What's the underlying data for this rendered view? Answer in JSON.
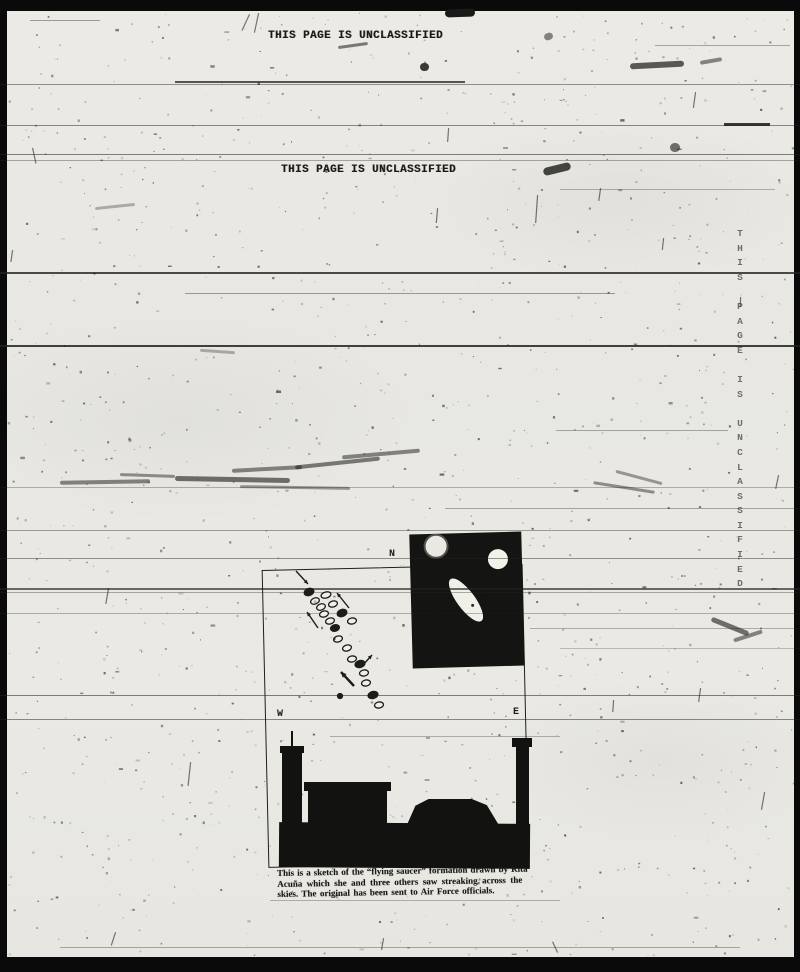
{
  "page": {
    "classification_header": "THIS PAGE IS UNCLASSIFIED",
    "classification_header_2": "THIS PAGE IS UNCLASSIFIED",
    "classification_vertical": "THIS PAGE IS UNCLASSIFIED"
  },
  "colors": {
    "paper": "#e9e8e2",
    "ink": "#191917",
    "border": "#0a0a0a",
    "faint_stamp": "#6e6d68"
  },
  "sketch": {
    "compass_n": "N",
    "compass_w": "W",
    "compass_e": "E",
    "caption_line1": "This is a sketch of the “flying saucer” formation drawn by Rita",
    "caption_line2": "Acuña which she and three others saw streaking across the",
    "caption_line3": "skies. The original has been sent to Air Force officials.",
    "saucers": [
      {
        "cx": 309,
        "cy": 592,
        "rx": 5,
        "ry": 3.5,
        "rot": -20,
        "filled": true
      },
      {
        "cx": 326,
        "cy": 595,
        "rx": 5,
        "ry": 3,
        "rot": -15,
        "filled": false
      },
      {
        "cx": 315,
        "cy": 601,
        "rx": 4.5,
        "ry": 3,
        "rot": -20,
        "filled": false
      },
      {
        "cx": 333,
        "cy": 604,
        "rx": 4.5,
        "ry": 3,
        "rot": -15,
        "filled": false
      },
      {
        "cx": 321,
        "cy": 607,
        "rx": 4.5,
        "ry": 3,
        "rot": -20,
        "filled": false
      },
      {
        "cx": 324,
        "cy": 614,
        "rx": 4.5,
        "ry": 3,
        "rot": -15,
        "filled": false
      },
      {
        "cx": 342,
        "cy": 613,
        "rx": 5,
        "ry": 3.5,
        "rot": -20,
        "filled": true
      },
      {
        "cx": 330,
        "cy": 621,
        "rx": 4.5,
        "ry": 3,
        "rot": -15,
        "filled": false
      },
      {
        "cx": 352,
        "cy": 621,
        "rx": 4.5,
        "ry": 3,
        "rot": -10,
        "filled": false
      },
      {
        "cx": 335,
        "cy": 628,
        "rx": 4.5,
        "ry": 3.2,
        "rot": -15,
        "filled": true
      },
      {
        "cx": 338,
        "cy": 639,
        "rx": 4.5,
        "ry": 3,
        "rot": -15,
        "filled": false
      },
      {
        "cx": 347,
        "cy": 648,
        "rx": 4.5,
        "ry": 3,
        "rot": -15,
        "filled": false
      },
      {
        "cx": 352,
        "cy": 659,
        "rx": 4.5,
        "ry": 3,
        "rot": -10,
        "filled": false
      },
      {
        "cx": 360,
        "cy": 664,
        "rx": 5,
        "ry": 3.5,
        "rot": -15,
        "filled": true
      },
      {
        "cx": 364,
        "cy": 673,
        "rx": 4.5,
        "ry": 3,
        "rot": -10,
        "filled": false
      },
      {
        "cx": 366,
        "cy": 683,
        "rx": 4.5,
        "ry": 3,
        "rot": -10,
        "filled": false
      },
      {
        "cx": 373,
        "cy": 695,
        "rx": 5,
        "ry": 3.5,
        "rot": -15,
        "filled": true
      },
      {
        "cx": 379,
        "cy": 705,
        "rx": 4.5,
        "ry": 3,
        "rot": -10,
        "filled": false
      },
      {
        "cx": 340,
        "cy": 696,
        "rx": 2.5,
        "ry": 2.5,
        "rot": 0,
        "filled": true
      }
    ],
    "arrows": [
      {
        "x1": 296,
        "y1": 571,
        "x2": 308,
        "y2": 584,
        "thick": false
      },
      {
        "x1": 349,
        "y1": 608,
        "x2": 337,
        "y2": 593,
        "thick": false
      },
      {
        "x1": 318,
        "y1": 628,
        "x2": 307,
        "y2": 612,
        "thick": false
      },
      {
        "x1": 362,
        "y1": 666,
        "x2": 372,
        "y2": 655,
        "thick": false
      },
      {
        "x1": 354,
        "y1": 686,
        "x2": 341,
        "y2": 672,
        "thick": true
      }
    ]
  },
  "artifacts": {
    "scan_lines": [
      {
        "y": 20,
        "x1": 30,
        "x2": 100,
        "o": 0.4,
        "h": 1
      },
      {
        "y": 45,
        "x1": 655,
        "x2": 790,
        "o": 0.35,
        "h": 1
      },
      {
        "y": 81,
        "x1": 175,
        "x2": 465,
        "o": 0.75,
        "h": 2
      },
      {
        "y": 84,
        "x1": 0,
        "x2": 800,
        "o": 0.45,
        "h": 1
      },
      {
        "y": 123,
        "x1": 724,
        "x2": 770,
        "o": 0.9,
        "h": 3
      },
      {
        "y": 125,
        "x1": 0,
        "x2": 800,
        "o": 0.5,
        "h": 1
      },
      {
        "y": 154,
        "x1": 0,
        "x2": 800,
        "o": 0.55,
        "h": 1
      },
      {
        "y": 160,
        "x1": 0,
        "x2": 800,
        "o": 0.35,
        "h": 1
      },
      {
        "y": 189,
        "x1": 560,
        "x2": 775,
        "o": 0.3,
        "h": 1
      },
      {
        "y": 272,
        "x1": 0,
        "x2": 800,
        "o": 0.8,
        "h": 2
      },
      {
        "y": 293,
        "x1": 185,
        "x2": 615,
        "o": 0.4,
        "h": 1
      },
      {
        "y": 345,
        "x1": 0,
        "x2": 800,
        "o": 0.85,
        "h": 2
      },
      {
        "y": 430,
        "x1": 556,
        "x2": 728,
        "o": 0.35,
        "h": 1
      },
      {
        "y": 487,
        "x1": 0,
        "x2": 800,
        "o": 0.3,
        "h": 1
      },
      {
        "y": 508,
        "x1": 445,
        "x2": 800,
        "o": 0.35,
        "h": 1
      },
      {
        "y": 530,
        "x1": 0,
        "x2": 800,
        "o": 0.4,
        "h": 1
      },
      {
        "y": 558,
        "x1": 0,
        "x2": 800,
        "o": 0.45,
        "h": 1
      },
      {
        "y": 588,
        "x1": 0,
        "x2": 800,
        "o": 0.65,
        "h": 2
      },
      {
        "y": 592,
        "x1": 0,
        "x2": 800,
        "o": 0.35,
        "h": 1
      },
      {
        "y": 613,
        "x1": 0,
        "x2": 800,
        "o": 0.3,
        "h": 1
      },
      {
        "y": 628,
        "x1": 530,
        "x2": 800,
        "o": 0.3,
        "h": 1
      },
      {
        "y": 648,
        "x1": 560,
        "x2": 800,
        "o": 0.25,
        "h": 1
      },
      {
        "y": 695,
        "x1": 0,
        "x2": 800,
        "o": 0.55,
        "h": 1
      },
      {
        "y": 719,
        "x1": 0,
        "x2": 800,
        "o": 0.5,
        "h": 1
      },
      {
        "y": 736,
        "x1": 330,
        "x2": 560,
        "o": 0.3,
        "h": 1
      },
      {
        "y": 900,
        "x1": 270,
        "x2": 560,
        "o": 0.3,
        "h": 1
      },
      {
        "y": 947,
        "x1": 60,
        "x2": 740,
        "o": 0.35,
        "h": 1
      }
    ],
    "smudges": [
      {
        "x": 338,
        "y": 44,
        "w": 30,
        "h": 3,
        "rot": -8,
        "o": 0.55
      },
      {
        "x": 420,
        "y": 63,
        "w": 9,
        "h": 8,
        "rot": 0,
        "o": 0.85
      },
      {
        "x": 445,
        "y": 9,
        "w": 30,
        "h": 8,
        "rot": -2,
        "o": 1
      },
      {
        "x": 630,
        "y": 62,
        "w": 54,
        "h": 6,
        "rot": -3,
        "o": 0.7
      },
      {
        "x": 700,
        "y": 59,
        "w": 22,
        "h": 4,
        "rot": -10,
        "o": 0.5
      },
      {
        "x": 543,
        "y": 165,
        "w": 28,
        "h": 8,
        "rot": -14,
        "o": 0.8
      },
      {
        "x": 544,
        "y": 33,
        "w": 9,
        "h": 7,
        "rot": -20,
        "o": 0.5
      },
      {
        "x": 670,
        "y": 143,
        "w": 10,
        "h": 9,
        "rot": 0,
        "o": 0.6
      },
      {
        "x": 95,
        "y": 205,
        "w": 40,
        "h": 3,
        "rot": -6,
        "o": 0.3
      },
      {
        "x": 200,
        "y": 350,
        "w": 35,
        "h": 3,
        "rot": 4,
        "o": 0.3
      },
      {
        "x": 60,
        "y": 480,
        "w": 90,
        "h": 4,
        "rot": -1,
        "o": 0.5
      },
      {
        "x": 120,
        "y": 474,
        "w": 55,
        "h": 3,
        "rot": 2,
        "o": 0.45
      },
      {
        "x": 175,
        "y": 477,
        "w": 115,
        "h": 5,
        "rot": 1,
        "o": 0.6
      },
      {
        "x": 232,
        "y": 467,
        "w": 70,
        "h": 4,
        "rot": -3,
        "o": 0.5
      },
      {
        "x": 295,
        "y": 461,
        "w": 85,
        "h": 4,
        "rot": -6,
        "o": 0.55
      },
      {
        "x": 342,
        "y": 452,
        "w": 78,
        "h": 4,
        "rot": -5,
        "o": 0.5
      },
      {
        "x": 240,
        "y": 486,
        "w": 110,
        "h": 3,
        "rot": 1,
        "o": 0.4
      },
      {
        "x": 593,
        "y": 486,
        "w": 62,
        "h": 3,
        "rot": 9,
        "o": 0.45
      },
      {
        "x": 615,
        "y": 476,
        "w": 48,
        "h": 3,
        "rot": 15,
        "o": 0.4
      },
      {
        "x": 710,
        "y": 624,
        "w": 40,
        "h": 5,
        "rot": 22,
        "o": 0.6
      },
      {
        "x": 733,
        "y": 634,
        "w": 30,
        "h": 4,
        "rot": -18,
        "o": 0.5
      }
    ],
    "ticks": [
      {
        "x": 249,
        "y": 14,
        "len": 18,
        "rot": 25
      },
      {
        "x": 258,
        "y": 13,
        "len": 20,
        "rot": 12
      },
      {
        "x": 537,
        "y": 195,
        "len": 28,
        "rot": 4
      },
      {
        "x": 695,
        "y": 92,
        "len": 16,
        "rot": 8
      },
      {
        "x": 437,
        "y": 208,
        "len": 15,
        "rot": 5
      },
      {
        "x": 600,
        "y": 188,
        "len": 13,
        "rot": 8
      },
      {
        "x": 448,
        "y": 128,
        "len": 14,
        "rot": 4
      },
      {
        "x": 663,
        "y": 238,
        "len": 12,
        "rot": 6
      },
      {
        "x": 740,
        "y": 297,
        "len": 10,
        "rot": 2
      },
      {
        "x": 108,
        "y": 588,
        "len": 16,
        "rot": 10
      },
      {
        "x": 190,
        "y": 762,
        "len": 24,
        "rot": 6
      },
      {
        "x": 764,
        "y": 792,
        "len": 18,
        "rot": 10
      },
      {
        "x": 778,
        "y": 475,
        "len": 14,
        "rot": 12
      },
      {
        "x": 700,
        "y": 688,
        "len": 14,
        "rot": 8
      },
      {
        "x": 613,
        "y": 700,
        "len": 12,
        "rot": 4
      },
      {
        "x": 115,
        "y": 932,
        "len": 14,
        "rot": 18
      },
      {
        "x": 552,
        "y": 942,
        "len": 12,
        "rot": -25
      },
      {
        "x": 383,
        "y": 938,
        "len": 12,
        "rot": 10
      },
      {
        "x": 32,
        "y": 148,
        "len": 16,
        "rot": -12
      },
      {
        "x": 12,
        "y": 250,
        "len": 12,
        "rot": 8
      }
    ]
  }
}
